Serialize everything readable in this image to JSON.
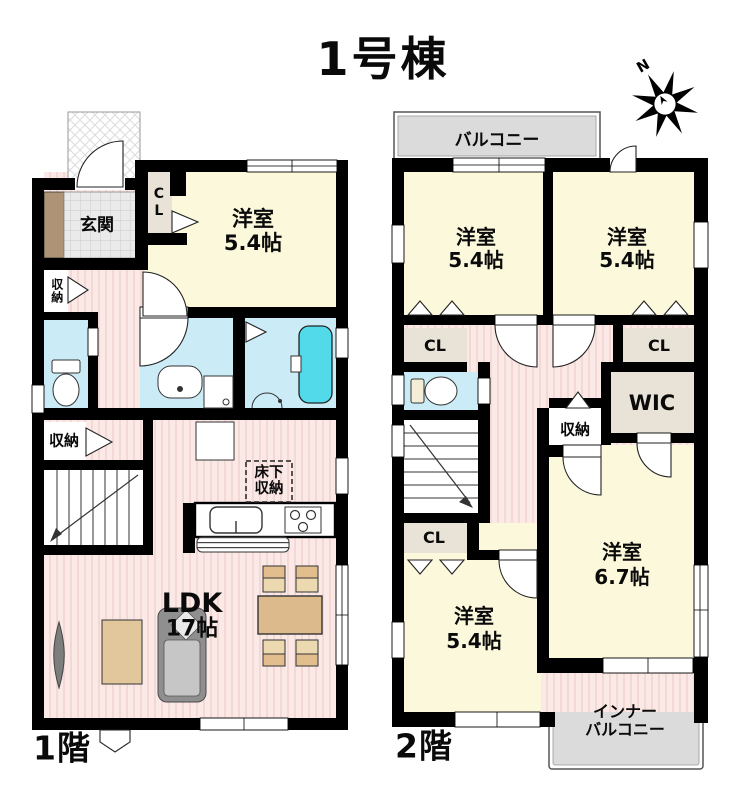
{
  "title": "1号棟",
  "compass_n": "N",
  "colors": {
    "wall": "#000000",
    "room_yellow": "#FBF8DB",
    "hall_pink": "#FAE9E6",
    "water_blue": "#CBECF7",
    "bathtub_cyan": "#52DAEB",
    "balcony_gray": "#DBDBDB",
    "closet_beige": "#E8E3D6",
    "entry_brown": "#AE9377"
  },
  "f1": {
    "label": "1階",
    "genkan": "玄関",
    "cl": "CL",
    "bedroom_name": "洋室",
    "bedroom_size": "5.4帖",
    "storage_a": "収納",
    "storage_b": "収納",
    "underfloor": "床下\n収納",
    "ldk_name": "LDK",
    "ldk_size": "17帖"
  },
  "f2": {
    "label": "2階",
    "balcony": "バルコニー",
    "bedroom_nw_name": "洋室",
    "bedroom_nw_size": "5.4帖",
    "bedroom_ne_name": "洋室",
    "bedroom_ne_size": "5.4帖",
    "bedroom_e_name": "洋室",
    "bedroom_e_size": "6.7帖",
    "bedroom_sw_name": "洋室",
    "bedroom_sw_size": "5.4帖",
    "cl_nw": "CL",
    "cl_ne": "CL",
    "cl_sw": "CL",
    "wic": "WIC",
    "storage": "収納",
    "inner_balcony": "インナー\nバルコニー"
  }
}
